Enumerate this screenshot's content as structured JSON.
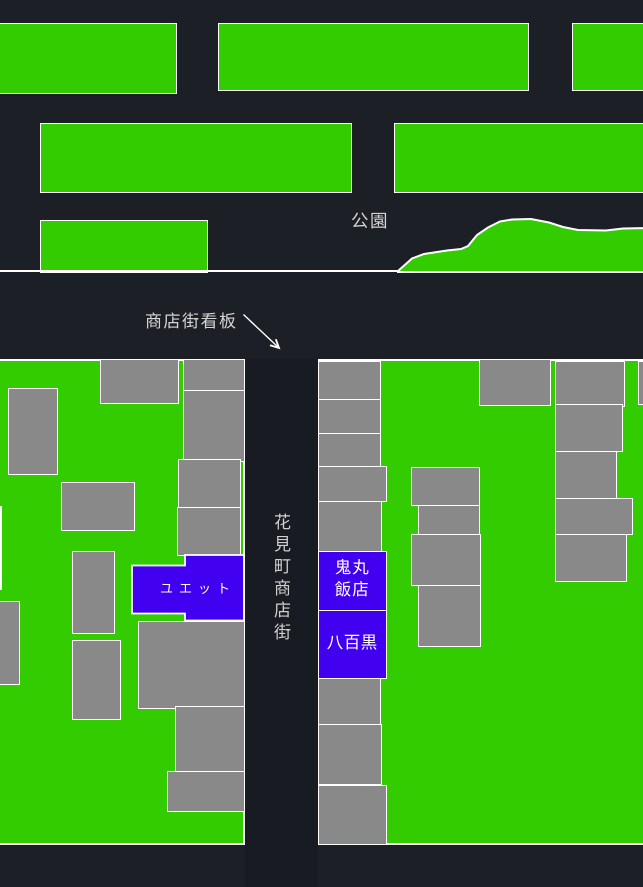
{
  "park": {
    "label": "公園"
  },
  "signboard": {
    "label": "商店街看板"
  },
  "street": {
    "label": "花見町商店街"
  },
  "shops": {
    "yuetto": {
      "label": "ユエット"
    },
    "onimaru": {
      "label": "鬼丸飯店",
      "line1": "鬼丸",
      "line2": "飯店"
    },
    "yaoguro": {
      "label": "八百黒"
    }
  },
  "colors": {
    "background": "#1c1f26",
    "road": "#181b21",
    "green": "#33cc00",
    "gray": "#898989",
    "blue": "#4100ef",
    "line": "#ffffff",
    "label": "#d4d4d4",
    "shoptext": "#ffffff"
  }
}
